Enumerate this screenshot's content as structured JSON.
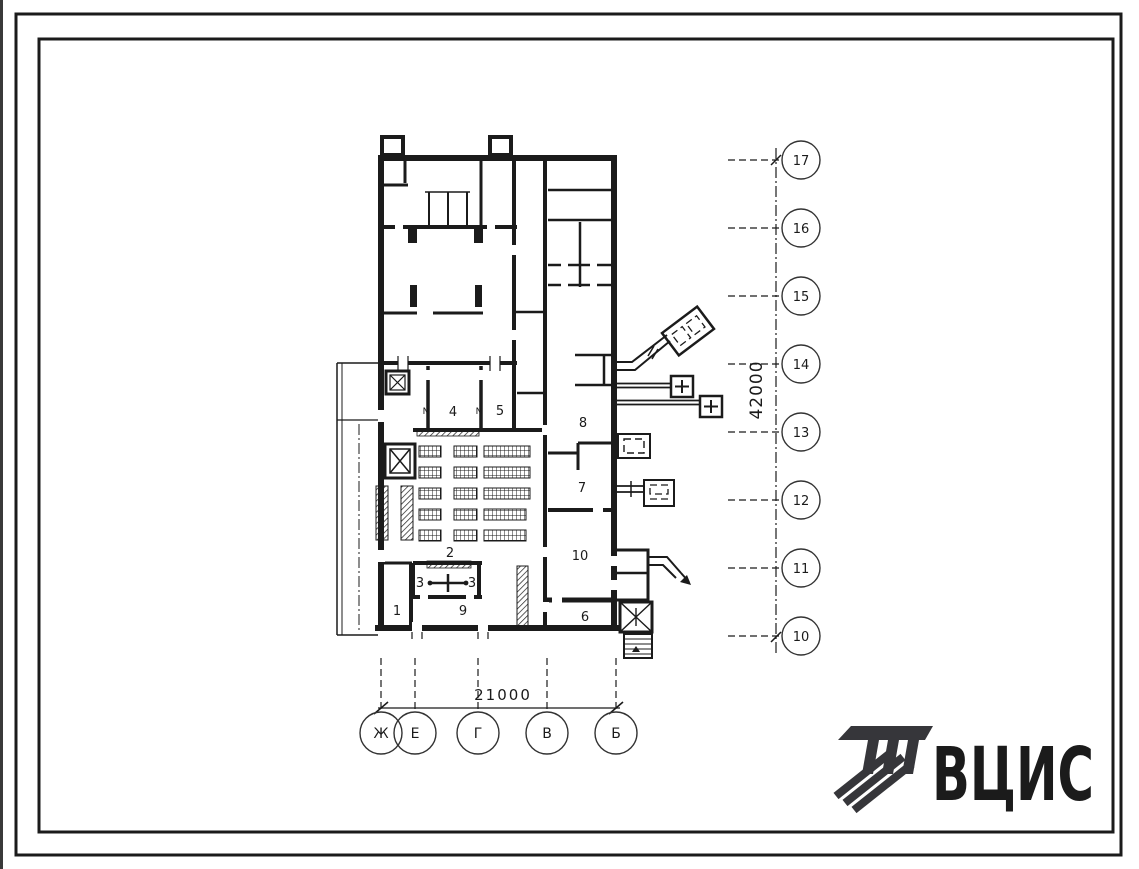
{
  "page": {
    "background": "#ffffff",
    "ink": "#1b1b1b"
  },
  "plan": {
    "rooms": [
      {
        "text": "1",
        "x": 397,
        "y": 615
      },
      {
        "text": "2",
        "x": 450,
        "y": 557
      },
      {
        "text": "3",
        "x": 420,
        "y": 587
      },
      {
        "text": "3",
        "x": 472,
        "y": 587
      },
      {
        "text": "4",
        "x": 453,
        "y": 416
      },
      {
        "text": "5",
        "x": 500,
        "y": 415
      },
      {
        "text": "6",
        "x": 585,
        "y": 621
      },
      {
        "text": "7",
        "x": 582,
        "y": 492
      },
      {
        "text": "8",
        "x": 583,
        "y": 427
      },
      {
        "text": "9",
        "x": 463,
        "y": 615
      },
      {
        "text": "10",
        "x": 580,
        "y": 560
      }
    ],
    "door_marks": [
      {
        "text": "N",
        "x": 426,
        "y": 414
      },
      {
        "text": "N",
        "x": 479,
        "y": 414
      }
    ]
  },
  "axes": {
    "right": {
      "dimension": "42000",
      "items": [
        {
          "label": "17",
          "cy": 160
        },
        {
          "label": "16",
          "cy": 228
        },
        {
          "label": "15",
          "cy": 296
        },
        {
          "label": "14",
          "cy": 364
        },
        {
          "label": "13",
          "cy": 432
        },
        {
          "label": "12",
          "cy": 500
        },
        {
          "label": "11",
          "cy": 568
        },
        {
          "label": "10",
          "cy": 636
        }
      ]
    },
    "bottom": {
      "dimension": "21000",
      "items": [
        {
          "label": "Ж",
          "cx": 381
        },
        {
          "label": "Е",
          "cx": 415
        },
        {
          "label": "Г",
          "cx": 478
        },
        {
          "label": "В",
          "cx": 547
        },
        {
          "label": "Б",
          "cx": 616
        }
      ]
    }
  },
  "logo": {
    "text": "ВЦИС",
    "color": "#36363a"
  }
}
